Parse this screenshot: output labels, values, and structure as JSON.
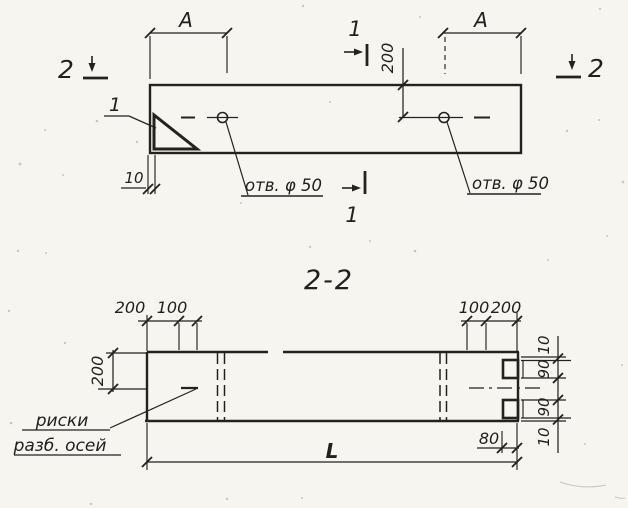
{
  "colors": {
    "ink": "#23221d",
    "paper": "#f6f5f0"
  },
  "top_view": {
    "section_mark_left": "2",
    "section_mark_right": "2",
    "cut_mark_top": "1",
    "cut_mark_bottom": "1",
    "detail_label": "1",
    "dim_span_left": "A",
    "dim_span_right": "A",
    "dim_hole_offset": "200",
    "dim_edge_gap": "10",
    "hole_label_left": "отв. φ 50",
    "hole_label_right": "отв. φ 50"
  },
  "section_view": {
    "title": "2-2",
    "dim_left_outer": "200",
    "dim_left_inner": "100",
    "dim_right_inner": "100",
    "dim_right_outer": "200",
    "dim_height": "200",
    "chain": [
      "10",
      "90",
      "90",
      "10"
    ],
    "dim_notch_depth": "80",
    "dim_length": "L",
    "axis_note_line1": "риски",
    "axis_note_line2": "разб. осей"
  }
}
